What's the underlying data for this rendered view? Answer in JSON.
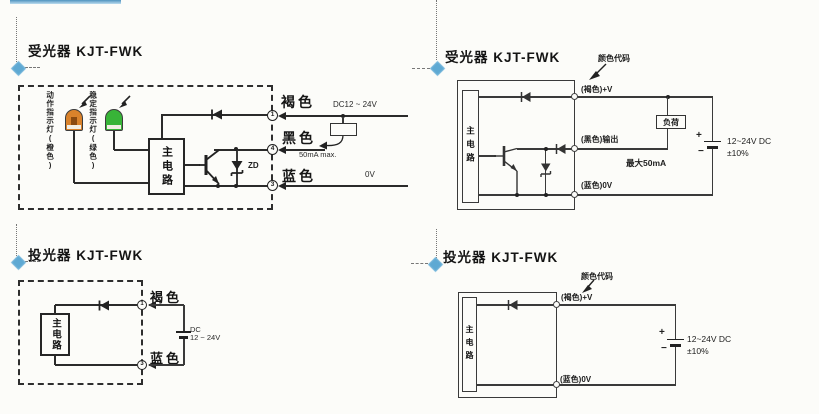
{
  "p1": {
    "title": "受光器 KJT-FWK",
    "lamp1_label": "动作指示灯(橙色)",
    "lamp2_label": "稳定指示灯(绿色)",
    "main_circuit": "主电路",
    "zd": "ZD",
    "t1": "1",
    "t2": "4",
    "t3": "3",
    "brown": "褐色",
    "black": "黑色",
    "blue": "蓝色",
    "supply": "DC12 ~ 24V",
    "current": "50mA max.",
    "zero_v": "0V"
  },
  "p2": {
    "title": "受光器 KJT-FWK",
    "color_code": "颜色代码",
    "main_circuit": "主电路",
    "brown_v": "(褐色)+V",
    "black_out": "(黑色)输出",
    "max_current": "最大50mA",
    "blue_0v": "(蓝色)0V",
    "load": "负荷",
    "plus": "+",
    "minus": "−",
    "supply1": "12~24V DC",
    "supply2": "±10%"
  },
  "p3": {
    "title": "投光器 KJT-FWK",
    "main_circuit": "主电路",
    "t1": "1",
    "t3": "3",
    "brown": "褐色",
    "blue": "蓝色",
    "supply1": "DC",
    "supply2": "12 ~ 24V"
  },
  "p4": {
    "title": "投光器 KJT-FWK",
    "color_code": "颜色代码",
    "main_circuit": "主电路",
    "brown_v": "(褐色)+V",
    "blue_0v": "(蓝色)0V",
    "plus": "+",
    "minus": "−",
    "supply1": "12~24V DC",
    "supply2": "±10%"
  },
  "colors": {
    "lamp_orange": "#d9822b",
    "lamp_green": "#38b438",
    "marker_blue": "#5ea9d3",
    "line": "#2b2b2b",
    "background": "#fcfcf9"
  }
}
